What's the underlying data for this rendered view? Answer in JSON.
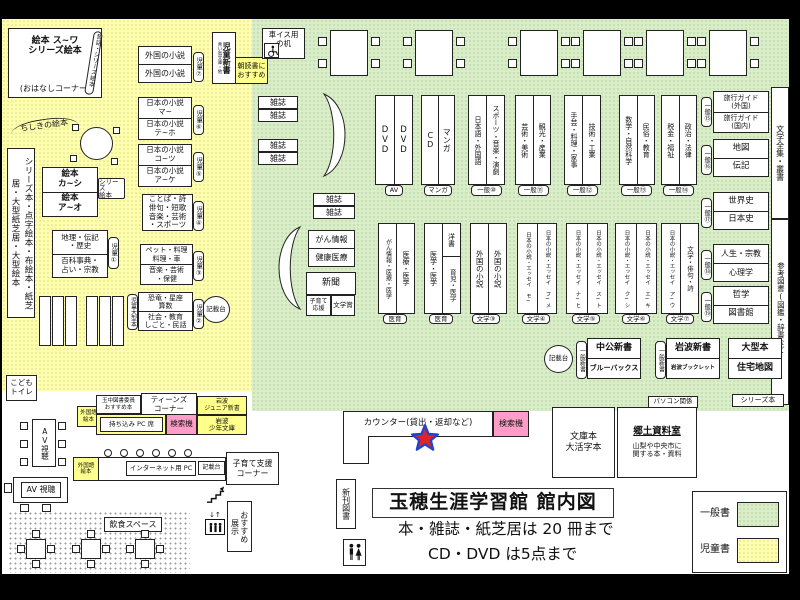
{
  "title": "玉穂生涯学習館 館内図",
  "notes": {
    "limit_books": "本・雑誌・紙芝居は 20 冊まで",
    "limit_av": "CD・DVD は5点まで"
  },
  "legend": {
    "general": "一般書",
    "children": "児童書"
  },
  "colors": {
    "general_bg": "#d9edc8",
    "children_bg": "#ffffb0",
    "search_pink": "#ff9dc8",
    "highlight_yellow": "#ffff8c"
  },
  "children_area": {
    "ohanashi_l1": "絵本 ス~ワ",
    "ohanashi_l2": "シリーズ絵本",
    "ohanashi_l3": "(おはなしコーナー)",
    "mukashibanashi": "昔話・シリーズ絵本",
    "chishiki": "ちしきの絵本",
    "series_braille_shelf": "シリーズ本・点字絵本・布絵本・紙芝居・大型紙芝居・大型絵本",
    "ehon_ka_shi": "絵本\nカ~シ",
    "ehon_a_o": "絵本\nア~オ",
    "series_ehon_tag": "シリーズ\n絵本",
    "chiri_rekishi": "地理・伝記\n・歴史",
    "hyakka": "百科事典・\n占い・宗教",
    "kotoba": "ことば・詩\n俳句・短歌\n音楽・芸術\n・スポーツ",
    "pet_ryori": "ペット・料理\n料理・車",
    "ongaku_hoken": "音楽・芸術\n・保健",
    "kyoryu_sansu": "恐竜・星座\n算数",
    "shakai_minwa": "社会・教育\nしごと・民話",
    "tag_jido1": "児童①",
    "tag_jido2": "児童②",
    "tag_jido3": "児童③",
    "tag_jido4": "児童④",
    "tag_jido5": "児童⑤",
    "tag_jido6": "児童⑥",
    "tag_jido7": "児童⑦",
    "jido_ogata": "児童大型本",
    "kisaidai": "記載台",
    "gaikoku_shosetsu": "外国の小説",
    "nihon_ma": "日本の小説\nマ~",
    "nihon_teho": "日本の小説\nテ~ホ",
    "nihon_kotsu": "日本の小説\nコ~ツ",
    "nihon_ake": "日本の小説\nア~ケ",
    "jido_shinsho": "児童新書",
    "aoitori": "青い鳥文庫・他",
    "asadoku": "朝読書に\nおすすめ",
    "kodomo_toilet": "こども\nトイレ"
  },
  "general_area": {
    "kurumaisu": "車イス用\nの机",
    "zasshi": "雑誌",
    "gan_joho": "がん情報",
    "kenko_iryo": "健康医療",
    "shinbun": "新聞",
    "kosodate_ouen": "子育て\n応援",
    "bungakusho": "文学賞",
    "dvd": "DVD",
    "av_cap": "AV",
    "cd": "CD",
    "manga": "マンガ",
    "manga_cap": "マンガ",
    "g10_c1": "日本語・外国語",
    "g10_c2": "スポーツ・音楽・演劇",
    "g10_cap": "一般⑩",
    "g11_c1": "芸術・美術",
    "g11_c2": "観光・産業",
    "g11_cap": "一般⑪",
    "g12_c1": "手芸・料理・家事",
    "g12_c2": "技術・工業",
    "g12_cap": "一般⑫",
    "g13_c1": "数学・自然科学",
    "g13_c2": "民俗・教育",
    "g13_cap": "一般⑬",
    "g14_c1": "税金・福祉",
    "g14_c2": "政治・法律",
    "g14_cap": "一般⑭",
    "g15_r1": "旅行ガイド\n(外国)",
    "g15_r2": "旅行ガイド\n(国内)",
    "g15_cap": "一般⑮",
    "g16_r1": "地図",
    "g16_r2": "伝記",
    "g16_cap": "一般⑯",
    "g17_r1": "世界史",
    "g17_r2": "日本史",
    "g17_cap": "一般⑰",
    "g18_r1": "人生・宗教",
    "g18_r2": "心理学",
    "g18_cap": "一般⑱",
    "g19_r1": "哲学",
    "g19_r2": "図書館",
    "g19_cap": "一般⑲",
    "bungaku_zenshu": "文学全集・叢書",
    "sanko_tosho": "参考図書(図鑑・辞書など)",
    "med1_c1": "がん情報・医療・医学",
    "med1_c2": "医療・医学",
    "med1_cap": "医育",
    "med2_c1": "医学・医学",
    "med2_c2a": "洋書",
    "med2_c2b": "育児・医学",
    "med2_cap": "医育",
    "b3_c1": "外国の小説",
    "b3_c2": "外国の小説",
    "b3_cap": "文学③",
    "b4_c1": "日本の小説・エッセイ モ~",
    "b4_c2": "日本の小説・エッセイ フ~メ",
    "b4_cap": "文学④",
    "b5_c1": "日本の小説・エッセイ ナ~ヒ",
    "b5_c2": "日本の小説・エッセイ ス~ト",
    "b5_cap": "文学⑤",
    "b6_c1": "日本の小説・エッセイ ク~シ",
    "b6_c2": "日本の小説・エッセイ エ~キ",
    "b6_cap": "文学⑥",
    "b7_c1": "日本の小説・エッセイ ア~ウ",
    "b7_c2": "文学・俳句・詩",
    "b7_cap": "文学⑦",
    "kisaidai": "記載台",
    "ippan_shinsho": "一般新書",
    "chuko_shinsho": "中公新書",
    "bluebacks": "ブルーバックス",
    "iwanami_shinsho": "岩波新書",
    "iwanami_booklet": "岩波ブックレット",
    "ogata_bon": "大型本",
    "jutaku_chizu": "住宅地図",
    "pasokon_kankei": "パソコン関係",
    "series_bon": "シリーズ本",
    "bunko": "文庫本\n大活字本",
    "kyodo_title": "郷土資料室",
    "kyodo_desc": "山梨や中央市に\n関する本・資料"
  },
  "service": {
    "counter": "カウンター(貸出・返却など)",
    "kensakuki": "検索機",
    "shinkan_tosho": "新刊図書",
    "av_shicho": "AV視聴",
    "av_shicho2": "AV 視聴",
    "gaikokugo_ehon": "外国語\n絵本",
    "tamachu_osusume": "玉中図書委員\nおすすめ本",
    "teens_corner": "ティーンズ\nコーナー",
    "iwanami_junior": "岩波\nジュニア新書",
    "mochikomi_pc": "持ち込み PC 席",
    "iwanami_shonen": "岩波\n少年文庫",
    "internet_pc": "インターネット用 PC",
    "kisaidai": "記載台",
    "kosodate_shien": "子育て支援\nコーナー",
    "osusume": "おすすめ",
    "tenji": "展示",
    "inshoku": "飲食スペース"
  }
}
